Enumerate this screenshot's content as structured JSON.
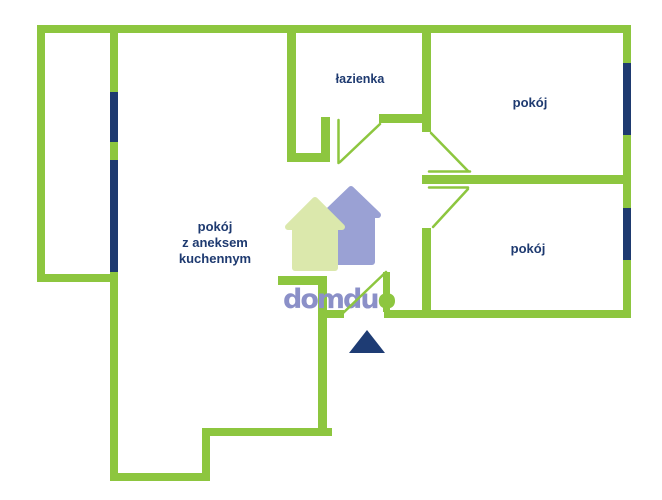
{
  "colors": {
    "wall": "#8dc63f",
    "window": "#1e3a70",
    "label": "#1e3a70",
    "triangle": "#1e3c74",
    "logo_primary": "#8b90c8",
    "logo_accent": "#8dc63f",
    "house_front": "#dbe8ac",
    "house_back": "#9aa1d4",
    "background": "#ffffff"
  },
  "labels": {
    "bathroom": "łazienka",
    "room_top": "pokój",
    "room_bottom": "pokój",
    "living": "pokój\nz aneksem\nkuchennym"
  },
  "watermark": {
    "primary": "domdu",
    "accent": "o"
  }
}
